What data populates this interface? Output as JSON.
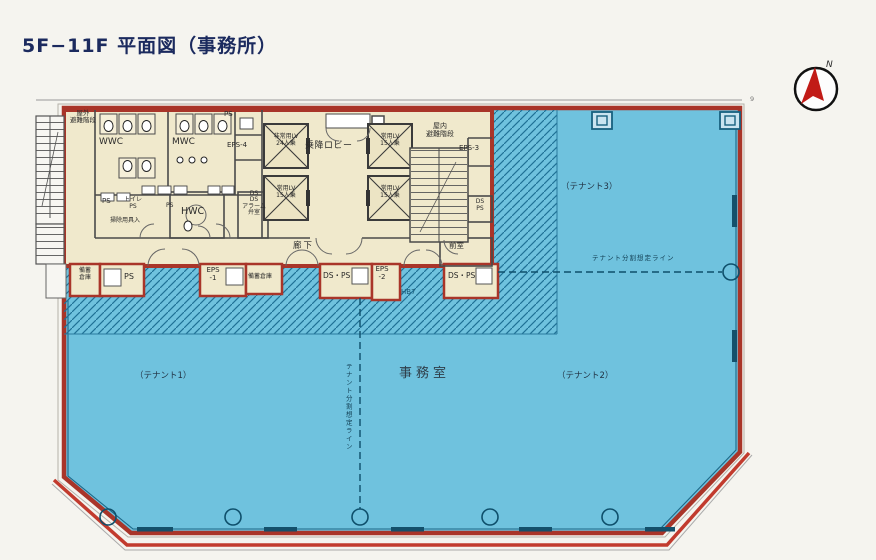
{
  "title": "5F−11F 平面図（事務所）",
  "compass": {
    "north_label": "N"
  },
  "colors": {
    "accent_red": "#a93529",
    "outer_red": "#c23b2e",
    "office_blue": "#6fc2de",
    "core_cream": "#f0e9cc",
    "hatch_teal": "#1f7096",
    "line_teal": "#14506b",
    "title_navy": "#1b2a5e",
    "compass_red": "#c11b17"
  },
  "plan": {
    "rooms": {
      "outdoor_stairs": "屋外\n避難階段",
      "wwc": "WWC",
      "mwc": "MWC",
      "ps_top": "PS",
      "eps4": "EPS-4",
      "lobby": "乗降ロビー",
      "elevator_emergency": "非常用LV\n24人乗",
      "elevator_passenger": "常用LV\n15人乗",
      "indoor_stairs": "屋内\n避難階段",
      "eps3": "EPS-3",
      "ps_mid": "PS",
      "toilet_ps": "トイレ\nPS",
      "cleaning": "掃除用具入",
      "ps_small": "PS",
      "hwc": "HWC",
      "ds_alarm": "DS\nDS\nアラーム\n弁室",
      "corridor": "廊下",
      "anteroom": "前室",
      "ds_ps_shaft": "DS\nPS"
    },
    "strip": {
      "stock_a": "備蓄\n倉庫",
      "ps": "PS",
      "eps1": "EPS\n-1",
      "stock_b": "備蓄倉庫",
      "ds_ps_a": "DS・PS",
      "eps2": "EPS\n-2",
      "ds_ps_b": "DS・PS"
    },
    "office": {
      "name": "事務室",
      "tenant1": "（テナント1）",
      "tenant2": "（テナント2）",
      "tenant3": "（テナント3）",
      "split_line_h": "テナント分割想定ライン",
      "split_line_v": "テナント分割想定ライン",
      "hatch_note": "HB7",
      "grid_no": "9"
    }
  }
}
